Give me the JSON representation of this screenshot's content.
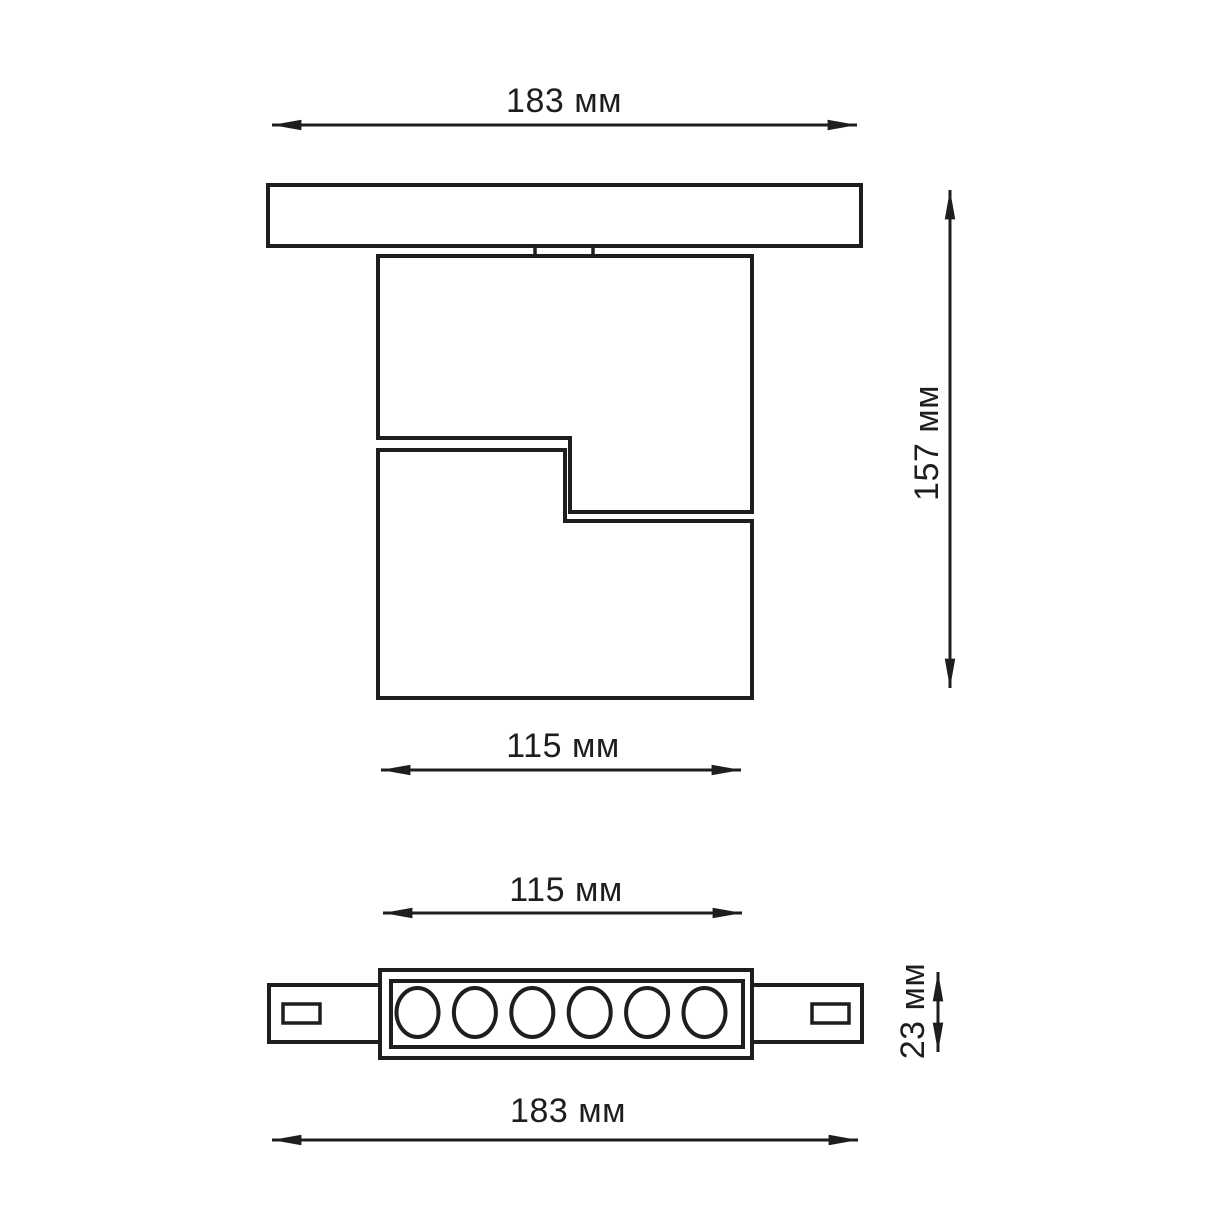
{
  "page": {
    "background_color": "#ffffff",
    "line_color": "#201d1d"
  },
  "drawing": {
    "unit": "мм",
    "side_view": {
      "dimensions": {
        "track_width_label": "183 мм",
        "overall_height_label": "157 мм",
        "body_width_label": "115 мм"
      }
    },
    "front_view": {
      "led_count": 6,
      "dimensions": {
        "body_width_label": "115 мм",
        "body_height_label": "23 мм",
        "track_width_label": "183 мм"
      }
    }
  }
}
